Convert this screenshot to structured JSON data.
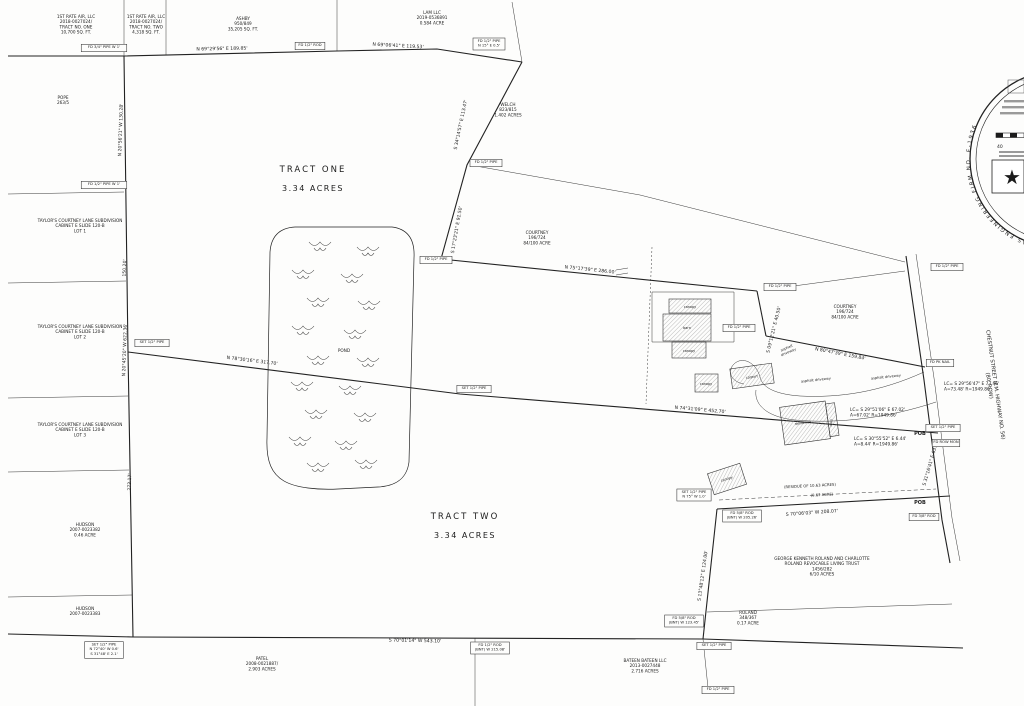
{
  "page": {
    "title": "Boundary Survey Plat",
    "background": "#fdfdfc",
    "ink": "#1b1b1b"
  },
  "tract_labels": [
    {
      "name": "TRACT ONE",
      "acres": "3.34 ACRES",
      "x": 313,
      "y": 172
    },
    {
      "name": "TRACT TWO",
      "acres": "3.34 ACRES",
      "x": 465,
      "y": 519
    }
  ],
  "parcels": [
    {
      "lines": [
        "1ST RATE AIR, LLC",
        "2018-0027024/",
        "TRACT NO. ONE",
        "10,700 SQ. FT."
      ],
      "x": 76,
      "y": 18
    },
    {
      "lines": [
        "1ST RATE AIR, LLC",
        "2018-0027024/",
        "TRACT NO. TWO",
        "4,318 SQ. FT."
      ],
      "x": 146,
      "y": 18
    },
    {
      "lines": [
        "ASHBY",
        "950/849",
        "35,205 SQ. FT."
      ],
      "x": 243,
      "y": 20
    },
    {
      "lines": [
        "LAM LLC",
        "2019-0536891",
        "0.584 ACRE"
      ],
      "x": 432,
      "y": 14
    },
    {
      "lines": [
        "WELCH",
        "823/815",
        "1.402 ACRES"
      ],
      "x": 508,
      "y": 106
    },
    {
      "lines": [
        "POPE",
        "263/5"
      ],
      "x": 63,
      "y": 99
    },
    {
      "lines": [
        "TAYLOR'S COURTNEY LANE SUBDIVISION",
        "CABINET E   SLIDE 120-B",
        "LOT 1"
      ],
      "x": 80,
      "y": 222
    },
    {
      "lines": [
        "TAYLOR'S COURTNEY LANE SUBDIVISION",
        "CABINET E   SLIDE 120-B",
        "LOT 2"
      ],
      "x": 80,
      "y": 328
    },
    {
      "lines": [
        "TAYLOR'S COURTNEY LANE SUBDIVISION",
        "CABINET E   SLIDE 120-B",
        "LOT 3"
      ],
      "x": 80,
      "y": 426
    },
    {
      "lines": [
        "HUDSON",
        "2007-0023382",
        "0.46 ACRE"
      ],
      "x": 85,
      "y": 526
    },
    {
      "lines": [
        "HUDSON",
        "2007-0023383"
      ],
      "x": 85,
      "y": 610
    },
    {
      "lines": [
        "PATEL",
        "2008-0021887/",
        "2.903 ACRES"
      ],
      "x": 262,
      "y": 660
    },
    {
      "lines": [
        "BATEEN BATEEN LLC",
        "2013-0027448",
        "2.716 ACRES"
      ],
      "x": 645,
      "y": 662
    },
    {
      "lines": [
        "COURTNEY",
        "196/724",
        "84/100 ACRE"
      ],
      "x": 537,
      "y": 234
    },
    {
      "lines": [
        "COURTNEY",
        "196/724",
        "84/100 ACRE"
      ],
      "x": 845,
      "y": 308
    },
    {
      "lines": [
        "GEORGE KENNETH ROLAND AND CHARLOTTE",
        "ROLAND REVOCABLE LIVING TRUST",
        "1456/282",
        "6/10 ACRES"
      ],
      "x": 822,
      "y": 560
    },
    {
      "lines": [
        "ROLAND",
        "348/367",
        "0.17 ACRE"
      ],
      "x": 748,
      "y": 614
    }
  ],
  "bearings": [
    {
      "t": "N 69°29'56\" E  189.85'",
      "x": 222,
      "y": 50,
      "r": -1
    },
    {
      "t": "N 69°06'41\" E  119.53'",
      "x": 398,
      "y": 47,
      "r": 3
    },
    {
      "t": "S 34°14'57\" E  113.47'",
      "x": 462,
      "y": 125,
      "r": -78
    },
    {
      "t": "S 17°23'21\" E  91.50'",
      "x": 458,
      "y": 230,
      "r": -80
    },
    {
      "t": "N 75°17'39\" E  286.00'",
      "x": 590,
      "y": 271,
      "r": 6
    },
    {
      "t": "S 09°12'21\" E  40.50'",
      "x": 775,
      "y": 330,
      "r": -76
    },
    {
      "t": "N 80°47'39\" E  159.84'",
      "x": 840,
      "y": 355,
      "r": 11
    },
    {
      "t": "N 20°56'21\" W  130.28'",
      "x": 122,
      "y": 130,
      "r": -88
    },
    {
      "t": "150.20'",
      "x": 126,
      "y": 268,
      "r": -88
    },
    {
      "t": "N 20°45'20\" W  622.36'",
      "x": 126,
      "y": 350,
      "r": -88
    },
    {
      "t": "273.17'",
      "x": 131,
      "y": 482,
      "r": -88
    },
    {
      "t": "N 78°30'16\" E  317.70'",
      "x": 252,
      "y": 362,
      "r": 7
    },
    {
      "t": "N 74°31'09\" E  452.70'",
      "x": 700,
      "y": 411,
      "r": 5
    },
    {
      "t": "S 70°01'14\" W  543.10'",
      "x": 415,
      "y": 642,
      "r": 1
    },
    {
      "t": "S 70°06'03\" W  208.07'",
      "x": 812,
      "y": 514,
      "r": -4
    },
    {
      "t": "S 13°48'12\" E  124.00'",
      "x": 704,
      "y": 576,
      "r": -82
    },
    {
      "t": "S 31°16'41\" E  63.26'",
      "x": 932,
      "y": 463,
      "r": -74
    }
  ],
  "curves": [
    {
      "lines": [
        "LC=  S 29°56'47\" E  73.46'",
        "A=73.48'  R=1949.86'"
      ],
      "x": 944,
      "y": 385
    },
    {
      "lines": [
        "LC=  S 29°51'06\" E  67.02'",
        "A=67.02'  R=1949.86'"
      ],
      "x": 850,
      "y": 411
    },
    {
      "lines": [
        "LC=  S 30°55'52\" E  6.44'",
        "A=8.44'  R=1949.86'"
      ],
      "x": 854,
      "y": 440
    }
  ],
  "monuments": [
    {
      "lines": [
        "FD 3/4\" PIPE  W 1'"
      ],
      "x": 104,
      "y": 48
    },
    {
      "lines": [
        "FD 1/2\" ROD"
      ],
      "x": 310,
      "y": 46
    },
    {
      "lines": [
        "FD 1/2\" PIPE",
        "N 15° E 0.5'"
      ],
      "x": 489,
      "y": 44
    },
    {
      "lines": [
        "FD 1/2\" PIPE  W 1'"
      ],
      "x": 104,
      "y": 185
    },
    {
      "lines": [
        "FD 1/2\" PIPE"
      ],
      "x": 486,
      "y": 163
    },
    {
      "lines": [
        "FD 1/2\" PIPE"
      ],
      "x": 436,
      "y": 260
    },
    {
      "lines": [
        "SET 1/2\" PIPE"
      ],
      "x": 152,
      "y": 343
    },
    {
      "lines": [
        "SET 1/2\" PIPE"
      ],
      "x": 474,
      "y": 389
    },
    {
      "lines": [
        "FD 1/2\" PIPE"
      ],
      "x": 780,
      "y": 287
    },
    {
      "lines": [
        "FD 1/2\" PIPE"
      ],
      "x": 739,
      "y": 328
    },
    {
      "lines": [
        "FD 1/2\" PIPE"
      ],
      "x": 947,
      "y": 267
    },
    {
      "lines": [
        "FD PK NAIL"
      ],
      "x": 940,
      "y": 363
    },
    {
      "lines": [
        "SET 1/2\" PIPE"
      ],
      "x": 943,
      "y": 428
    },
    {
      "lines": [
        "FD ROW MON"
      ],
      "x": 946,
      "y": 443
    },
    {
      "lines": [
        "FD 3/8\" ROD"
      ],
      "x": 924,
      "y": 517
    },
    {
      "lines": [
        "SET 1/2\" PIPE",
        "N 75° W 1.0'"
      ],
      "x": 694,
      "y": 495
    },
    {
      "lines": [
        "FD 5/8\" ROD",
        "(BNT) W 205.26'"
      ],
      "x": 742,
      "y": 516
    },
    {
      "lines": [
        "FD 5/8\" ROD",
        "(BNT) W 123.45'"
      ],
      "x": 684,
      "y": 621
    },
    {
      "lines": [
        "SET 1/2\" PIPE"
      ],
      "x": 714,
      "y": 646
    },
    {
      "lines": [
        "SET 1/2\" PIPE",
        "N 72°40' W 0.6'",
        "S 31°48' E 2.1'"
      ],
      "x": 104,
      "y": 650
    },
    {
      "lines": [
        "FD 1/2\" ROD",
        "(BNT) W 215.08'"
      ],
      "x": 490,
      "y": 648
    },
    {
      "lines": [
        "FD 1/2\" PIPE"
      ],
      "x": 718,
      "y": 690
    }
  ],
  "pob": [
    {
      "t": "POB",
      "x": 920,
      "y": 435
    },
    {
      "t": "POB",
      "x": 920,
      "y": 504
    }
  ],
  "misc_labels": [
    {
      "lines": [
        "POND"
      ],
      "x": 344,
      "y": 352,
      "r": 0,
      "size": 4.2,
      "name": "pond-label"
    },
    {
      "lines": [
        "(RESIDUE OF 10.63 ACRES)"
      ],
      "x": 810,
      "y": 487,
      "r": -3,
      "size": 3.8,
      "name": "residue-label"
    },
    {
      "lines": [
        "(0.67 ACRE)"
      ],
      "x": 822,
      "y": 496,
      "r": -3,
      "size": 3.8,
      "name": "residue-acreage-label"
    },
    {
      "lines": [
        "asphalt",
        "driveway"
      ],
      "x": 787,
      "y": 349,
      "r": -24,
      "size": 3.5,
      "name": "driveway-label"
    },
    {
      "lines": [
        "asphalt driveway"
      ],
      "x": 816,
      "y": 381,
      "r": -6,
      "size": 3.5,
      "name": "driveway-label"
    },
    {
      "lines": [
        "asphalt driveway"
      ],
      "x": 886,
      "y": 378,
      "r": -6,
      "size": 3.5,
      "name": "driveway-label"
    },
    {
      "lines": [
        "CHESTNUT STREET (F.M. HIGHWAY NO. 56)",
        "(80' ROW)"
      ],
      "x": 994,
      "y": 385,
      "r": 82,
      "size": 5.2,
      "name": "road-label"
    }
  ],
  "building_labels": [
    {
      "lines": [
        "canopy"
      ],
      "x": 690,
      "y": 308,
      "r": 0,
      "size": 3.4,
      "name": "building-label-canopy"
    },
    {
      "lines": [
        "barn"
      ],
      "x": 687,
      "y": 329,
      "r": 0,
      "size": 3.4,
      "name": "building-label-barn"
    },
    {
      "lines": [
        "canopy"
      ],
      "x": 689,
      "y": 352,
      "r": 0,
      "size": 3.4,
      "name": "building-label-canopy"
    },
    {
      "lines": [
        "canopy"
      ],
      "x": 706,
      "y": 385,
      "r": 0,
      "size": 3.4,
      "name": "building-label-canopy"
    },
    {
      "lines": [
        "carport"
      ],
      "x": 752,
      "y": 378,
      "r": -8,
      "size": 3.4,
      "name": "building-label-carport"
    },
    {
      "lines": [
        "residence"
      ],
      "x": 803,
      "y": 424,
      "r": -8,
      "size": 3.4,
      "name": "building-label-residence"
    },
    {
      "lines": [
        "shed"
      ],
      "x": 832,
      "y": 423,
      "r": -82,
      "size": 3.0,
      "name": "building-label-shed"
    },
    {
      "lines": [
        "canopy"
      ],
      "x": 727,
      "y": 480,
      "r": -18,
      "size": 3.4,
      "name": "building-label-canopy"
    }
  ],
  "seal": {
    "ring_text": "TEXAS ENGINEERING FIRM NO. F-1936",
    "scale_number": "40",
    "star": "★"
  }
}
